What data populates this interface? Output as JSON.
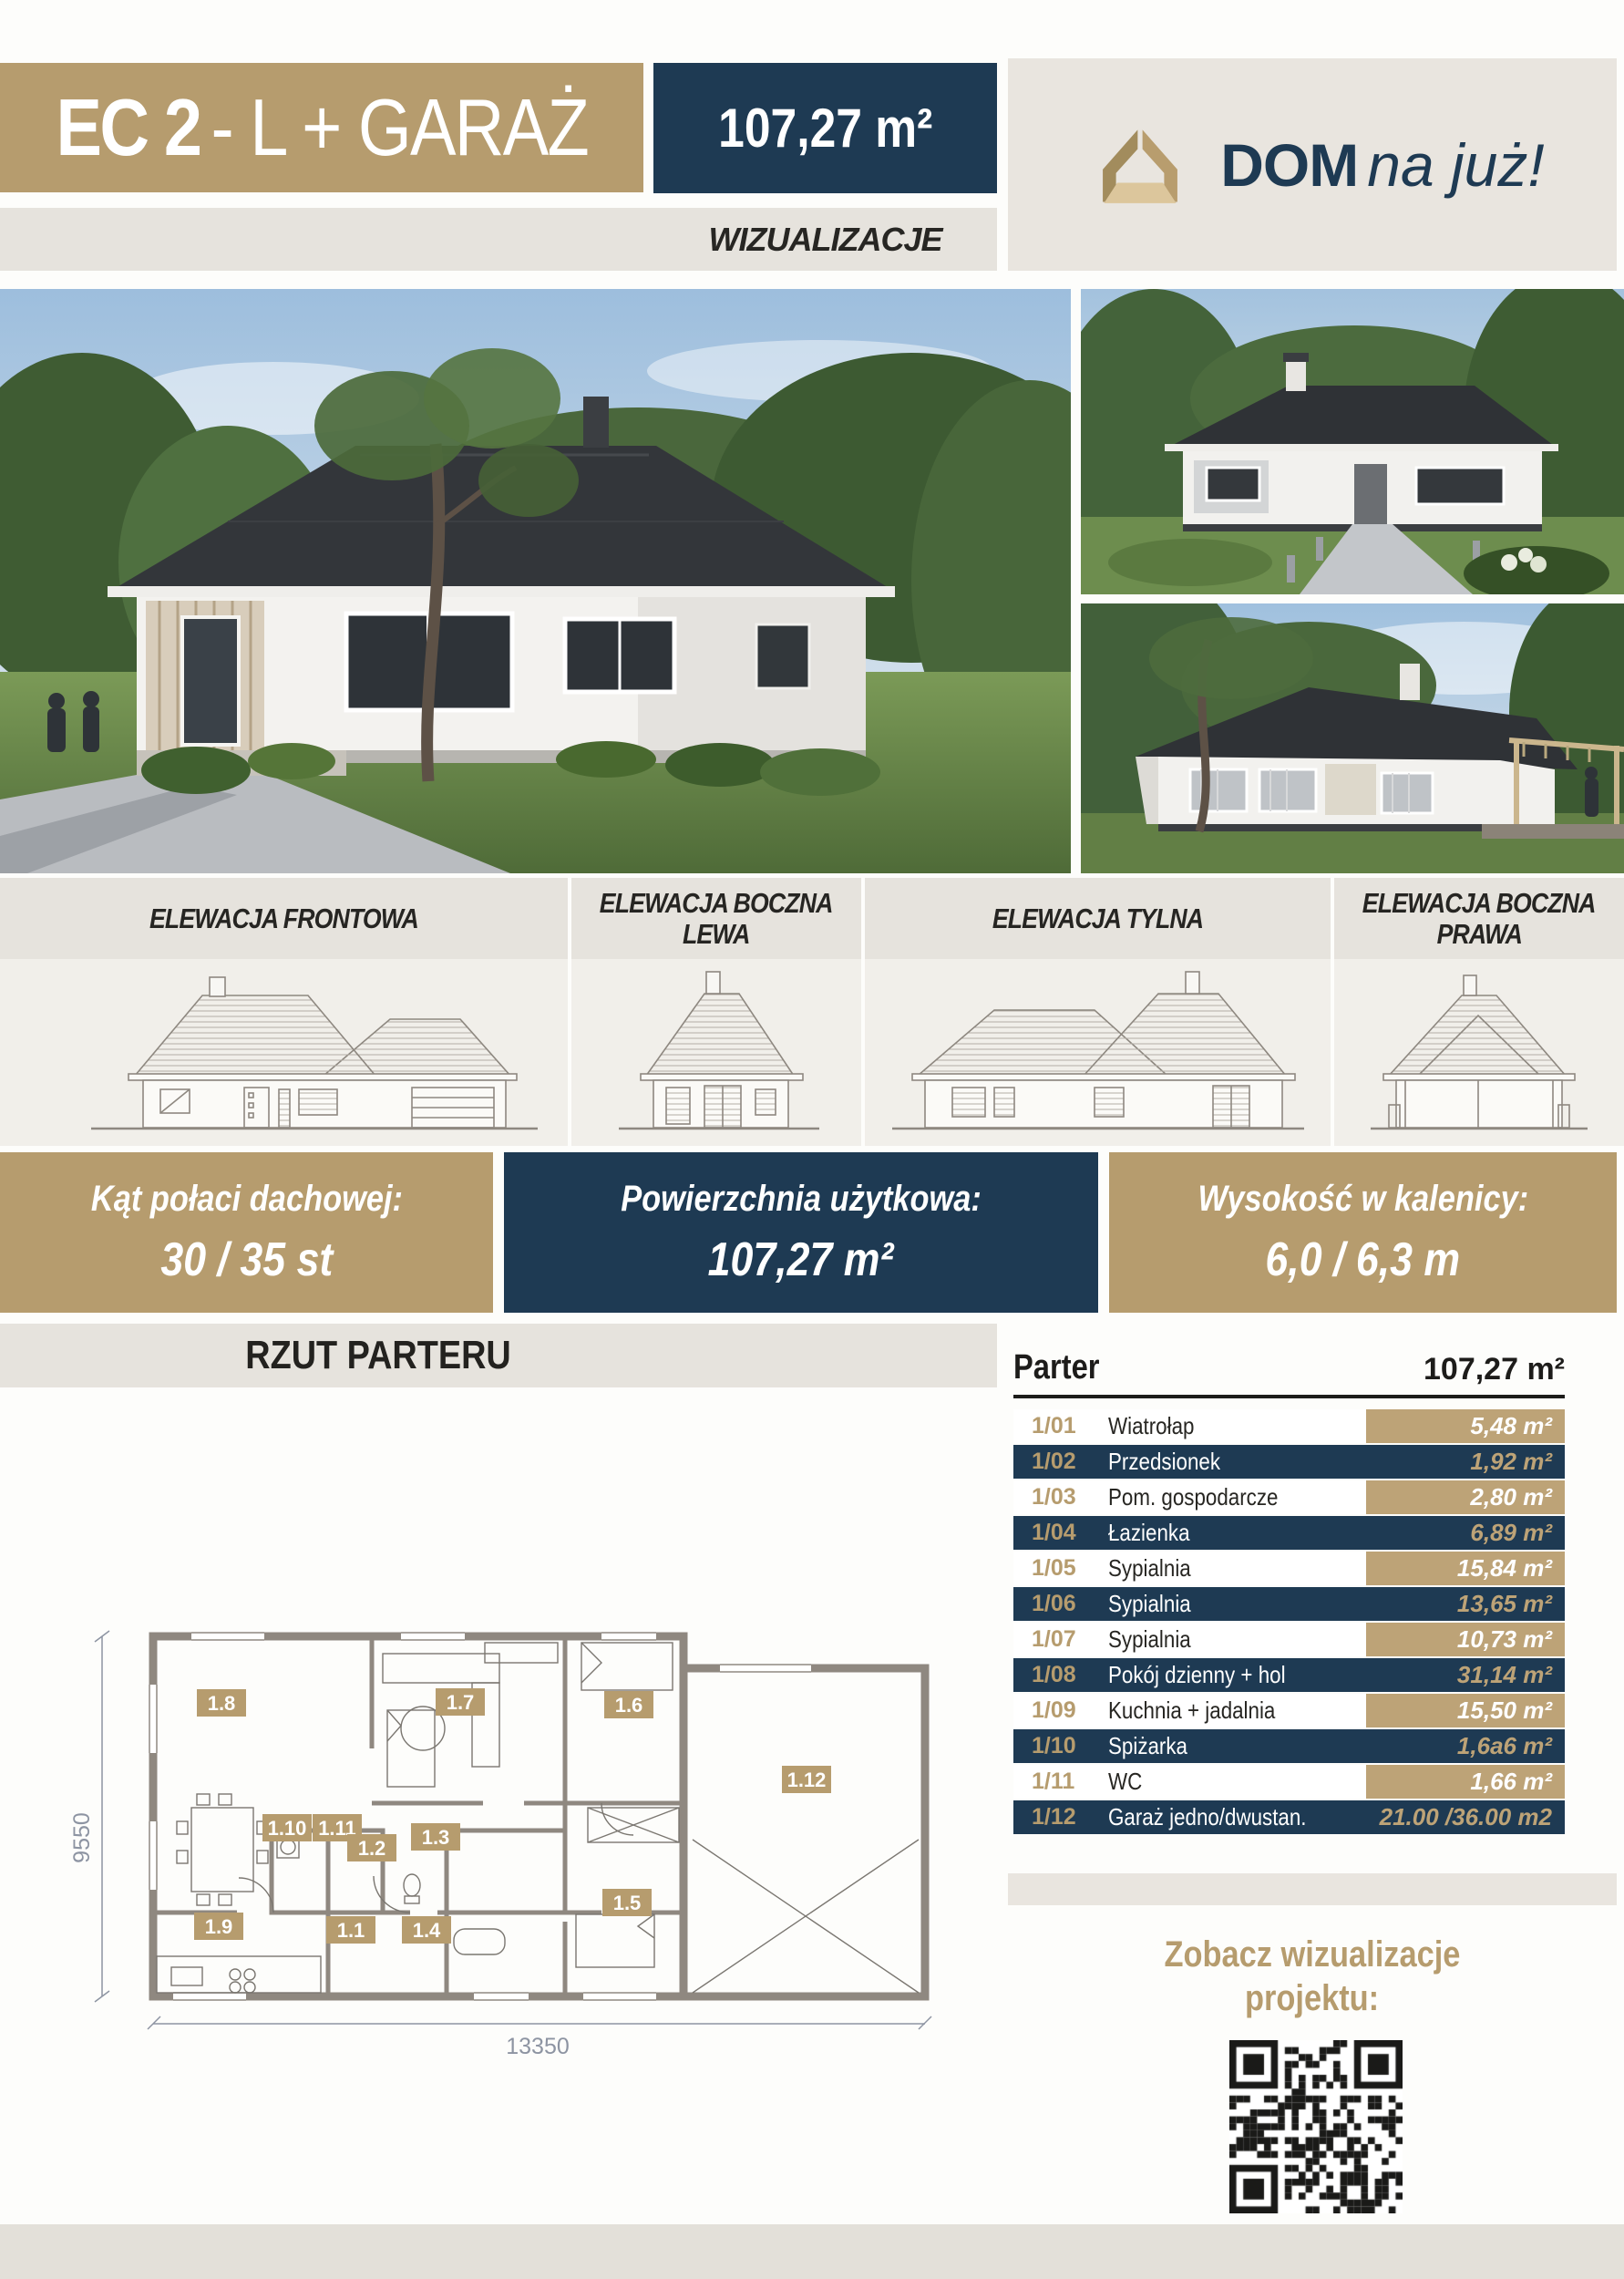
{
  "header": {
    "project_code": "EC 2",
    "project_suffix": "- L + GARAŻ",
    "area_badge": "107,27 m²",
    "section_label": "WIZUALIZACJE",
    "logo": {
      "brand_bold": "DOM",
      "brand_italic": "na już!"
    }
  },
  "elevations": {
    "items": [
      {
        "l1": "ELEWACJA FRONTOWA",
        "l2": ""
      },
      {
        "l1": "ELEWACJA BOCZNA",
        "l2": "LEWA"
      },
      {
        "l1": "ELEWACJA TYLNA",
        "l2": ""
      },
      {
        "l1": "ELEWACJA BOCZNA",
        "l2": "PRAWA"
      }
    ]
  },
  "specs": {
    "items": [
      {
        "label": "Kąt połaci dachowej:",
        "value": "30 / 35 st"
      },
      {
        "label": "Powierzchnia użytkowa:",
        "value": "107,27 m²"
      },
      {
        "label": "Wysokość w kalenicy:",
        "value": "6,0 / 6,3 m"
      }
    ]
  },
  "floor_plan": {
    "title": "RZUT PARTERU",
    "width_dim": "13350",
    "height_dim": "9550",
    "room_labels": [
      "1.8",
      "1.7",
      "1.6",
      "1.12",
      "1.10",
      "1.11",
      "1.2",
      "1.3",
      "1.9",
      "1.1",
      "1.4",
      "1.5"
    ]
  },
  "room_table": {
    "title": "Parter",
    "total": "107,27 m²",
    "rows": [
      {
        "no": "1/01",
        "name": "Wiatrołap",
        "area": "5,48 m²"
      },
      {
        "no": "1/02",
        "name": "Przedsionek",
        "area": "1,92 m²"
      },
      {
        "no": "1/03",
        "name": "Pom. gospodarcze",
        "area": "2,80 m²"
      },
      {
        "no": "1/04",
        "name": "Łazienka",
        "area": "6,89 m²"
      },
      {
        "no": "1/05",
        "name": "Sypialnia",
        "area": "15,84 m²"
      },
      {
        "no": "1/06",
        "name": "Sypialnia",
        "area": "13,65 m²"
      },
      {
        "no": "1/07",
        "name": "Sypialnia",
        "area": "10,73 m²"
      },
      {
        "no": "1/08",
        "name": "Pokój dzienny + hol",
        "area": "31,14 m²"
      },
      {
        "no": "1/09",
        "name": "Kuchnia + jadalnia",
        "area": "15,50 m²"
      },
      {
        "no": "1/10",
        "name": "Spiżarka",
        "area": "1,6a6 m²"
      },
      {
        "no": "1/11",
        "name": "WC",
        "area": "1,66 m²"
      },
      {
        "no": "1/12",
        "name": "Garaż jedno/dwustan.",
        "area": "21.00 /36.00 m2"
      }
    ]
  },
  "qr_section": {
    "caption_line1": "Zobacz wizualizacje",
    "caption_line2": "projektu:"
  },
  "colors": {
    "accent_tan": "#b69c6e",
    "accent_navy": "#1e3a53",
    "band_gray": "#e6e3dd",
    "panel_beige": "#e9e5df"
  }
}
